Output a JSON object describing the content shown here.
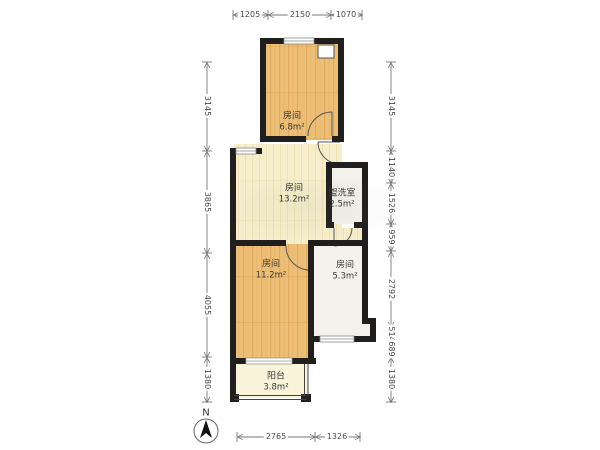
{
  "plan": {
    "rooms": [
      {
        "name": "房间",
        "area": "6.8m²"
      },
      {
        "name": "房间",
        "area": "13.2m²"
      },
      {
        "name": "盥洗室",
        "area": "2.5m²"
      },
      {
        "name": "房间",
        "area": "11.2m²"
      },
      {
        "name": "房间",
        "area": "5.3m²"
      },
      {
        "name": "阳台",
        "area": "3.8m²"
      }
    ],
    "compass": {
      "label": "N"
    }
  },
  "dimensions": {
    "top": [
      "1205",
      "2150",
      "1070"
    ],
    "bottom": [
      "2765",
      "1326"
    ],
    "left": [
      "3145",
      "3865",
      "4055",
      "1380"
    ],
    "right": [
      "3145",
      "1140",
      "1526",
      "959",
      "2792",
      "514",
      "689",
      "1380"
    ]
  },
  "colors": {
    "wall": "#201f1d",
    "wood_floor": "#edbf76",
    "cream_floor": "#f6eecb",
    "tile_floor": "#f2f1ec",
    "dimension_text": "#4a4a4a"
  }
}
